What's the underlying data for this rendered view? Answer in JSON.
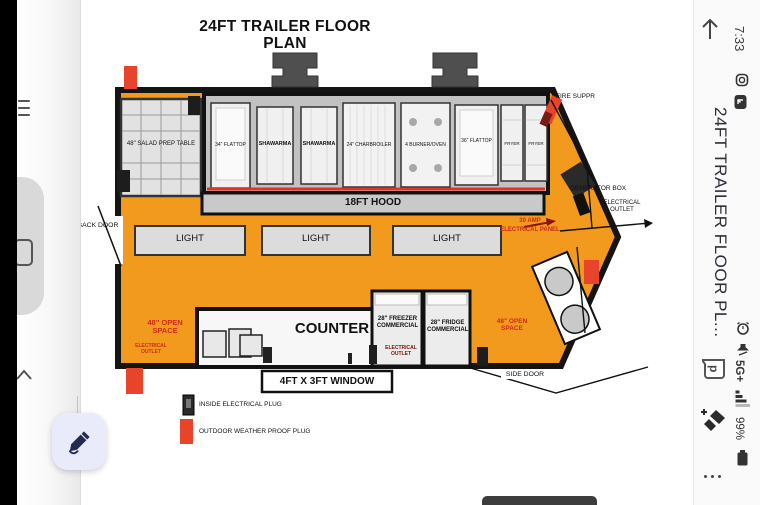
{
  "sidebar": {
    "time": "7:33",
    "doc_title": "24FT TRAILER FLOOR PL...",
    "network": "5G+",
    "battery_pct": "99%"
  },
  "floor_plan": {
    "title": "24FT TRAILER FLOOR PLAN",
    "hood_label": "18FT HOOD",
    "lights": [
      "LIGHT",
      "LIGHT",
      "LIGHT"
    ],
    "equipment": {
      "salad_table": "48\" SALAD PREP TABLE",
      "flattop_34": "34\" FLATTOP",
      "shawarma_1": "SHAWARMA",
      "shawarma_2": "SHAWARMA",
      "charbroiler": "24\" CHARBROILER",
      "burner_oven": "4 BURNER/OVEN",
      "flattop_36": "36\" FLATTOP",
      "fryer_1": "FRYER",
      "fryer_2": "FRYER"
    },
    "counter_label": "COUNTER",
    "window_label": "4FT X 3FT WINDOW",
    "freezer_label": "28\" FREEZER COMMERCIAL",
    "fridge_label": "28\" FRIDGE COMMERCIAL",
    "open_space_left": "48\" OPEN SPACE",
    "open_space_right": "48\" OPEN SPACE",
    "electrical_outlet_left": "ELECTRICAL OUTLET",
    "electrical_outlet_mid": "ELECTRICAL OUTLET",
    "electrical_outlet_right": "ELECTRICAL OUTLET",
    "back_door": "BACK DOOR",
    "side_door": "SIDE DOOR",
    "fire_suppression": "FIRE SUPPR",
    "generator_box": "GENERATOR BOX",
    "amp_line1": "30 AMP",
    "amp_line2": "ELECTRICAL PANEL",
    "legend": {
      "inside": "INSIDE ELECTRICAL PLUG",
      "outdoor": "OUTDOOR WEATHER PROOF PLUG"
    }
  },
  "colors": {
    "trailer_orange": "#F29A1E",
    "plug_red": "#E8432B",
    "annotation_red": "#CF2A17"
  }
}
